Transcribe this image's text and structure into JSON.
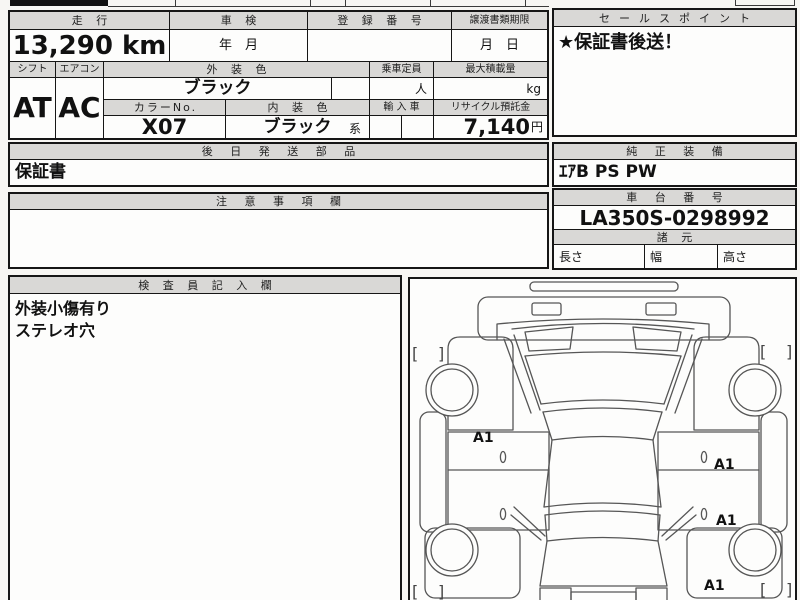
{
  "sheet": {
    "mileage": {
      "label": "走 行",
      "value": "13,290 km"
    },
    "inspection": {
      "label": "車 検",
      "value": "年　月"
    },
    "registration": {
      "label": "登 録 番 号",
      "value": ""
    },
    "transfer_deadline": {
      "label": "譲渡書類期限",
      "value": "月　日"
    },
    "sales_point": {
      "label": "セールスポイント",
      "value": "★保証書後送！"
    },
    "shift": {
      "label": "シフト",
      "value": "AT"
    },
    "aircon": {
      "label": "エアコン",
      "value": "AC"
    },
    "exterior_color": {
      "label": "外 装 色",
      "value": "ブラック"
    },
    "capacity": {
      "label": "乗車定員",
      "unit": "人"
    },
    "max_load": {
      "label": "最大積載量",
      "unit": "kg"
    },
    "color_no": {
      "label": "カラーNo.",
      "value": "X07"
    },
    "interior_color": {
      "label": "内 装 色",
      "value": "ブラック",
      "suffix": "系"
    },
    "imported": {
      "label": "輸 入 車",
      "value": ""
    },
    "recycle_deposit": {
      "label": "リサイクル預託金",
      "value": "7,140",
      "unit": "円"
    },
    "later_shipped_parts": {
      "label": "後 日 発 送 部 品",
      "value": "保証書"
    },
    "genuine_equipment": {
      "label": "純 正 装 備",
      "value": "ｴｱB PS PW"
    },
    "notes": {
      "label": "注 意 事 項 欄",
      "value": ""
    },
    "chassis_number": {
      "label": "車 台 番 号",
      "value": "LA350S-0298992"
    },
    "specs": {
      "label": "諸 元",
      "length": "長さ",
      "width": "幅",
      "height": "高さ"
    },
    "inspector_notes": {
      "label": "検 査 員 記 入 欄",
      "lines": [
        "外装小傷有り",
        "ステレオ穴"
      ]
    }
  },
  "diagram": {
    "marks": [
      {
        "text": "A1"
      },
      {
        "text": "A1"
      },
      {
        "text": "A1"
      },
      {
        "text": "A1"
      }
    ],
    "bracket_open": "[",
    "bracket_close": "]"
  },
  "colors": {
    "header_fill": "#d9d8d6",
    "border": "#161616",
    "paper": "#fdfdfc",
    "line": "#565656"
  }
}
